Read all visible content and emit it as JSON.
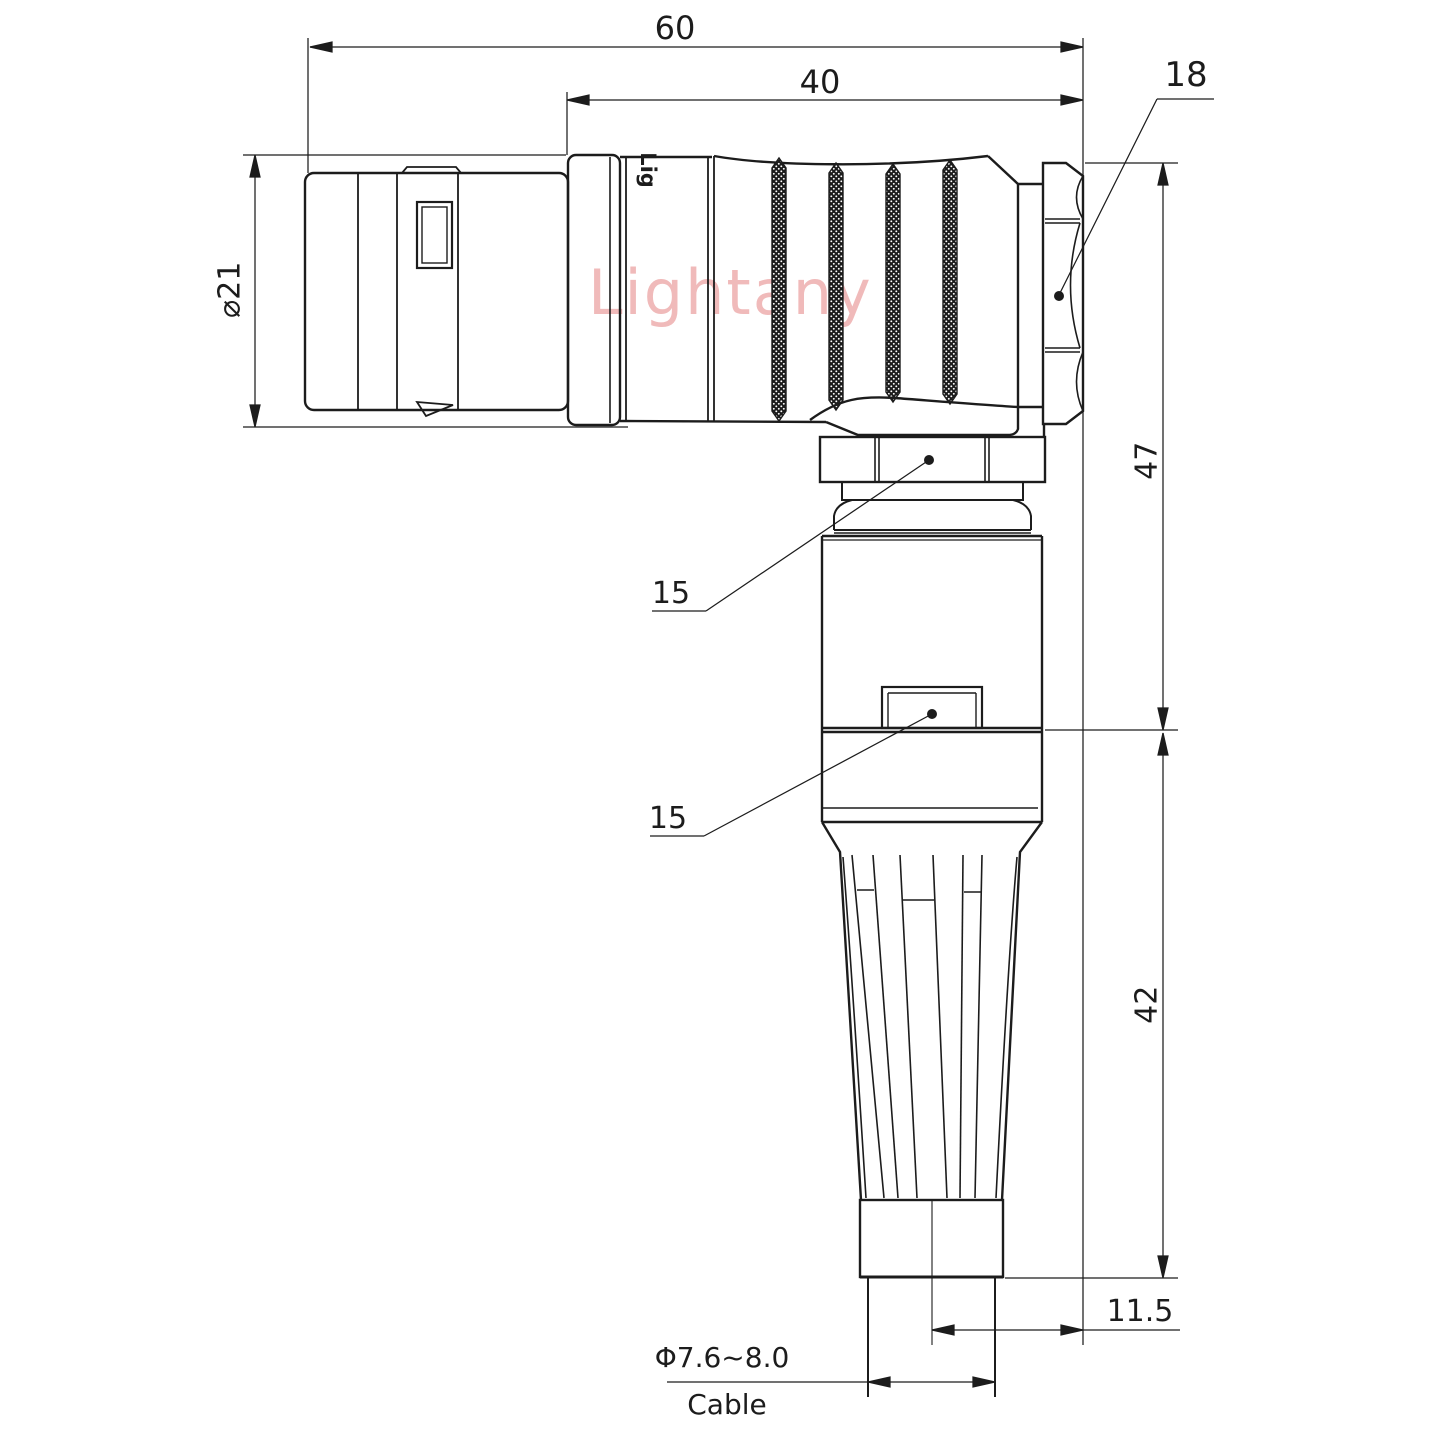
{
  "watermark": "Lightany",
  "part_logo": "Lig",
  "dimensions": {
    "overall_length": "60",
    "rear_length": "40",
    "hex_width": "18",
    "shell_diameter": "⌀21",
    "upper_height": "47",
    "lower_height": "42",
    "axis_offset": "11.5",
    "cable_range": "Φ7.6~8.0",
    "cable_label": "Cable",
    "callout_upper": "15",
    "callout_lower": "15"
  },
  "colors": {
    "line": "#1c1c1c",
    "watermark": "#f0baba"
  }
}
